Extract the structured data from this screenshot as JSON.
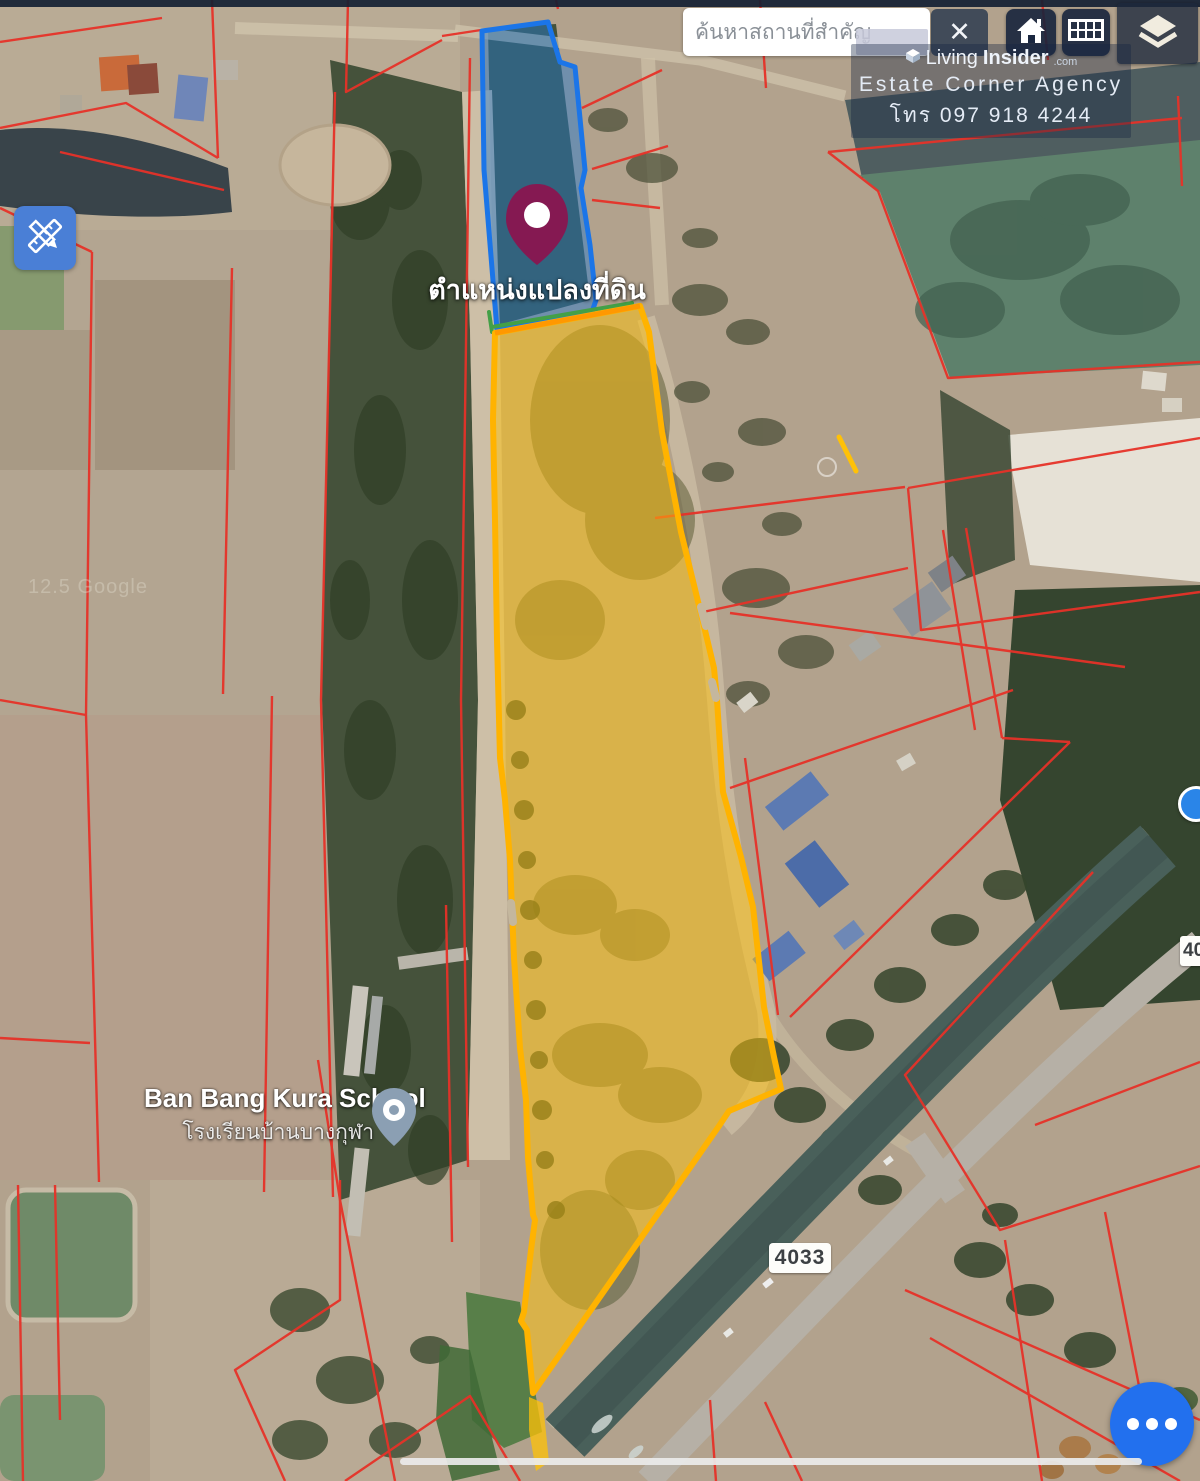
{
  "theme": {
    "plot_fill_yellow": "#FFC107",
    "plot_border_yellow": "#FFB300",
    "plot_top_border_orange": "#FF9800",
    "plot_border_green": "#43A047",
    "plot_fill_blue": "#1E78D2",
    "plot_border_blue": "#1B75E8",
    "parcel_line_red": "#E63228",
    "pin_color": "#8A1550",
    "fab_blue": "#2270EE",
    "edit_button_blue": "#4A7FD6",
    "control_bg_navy": "#16243C"
  },
  "search": {
    "placeholder": "ค้นหาสถานที่สำคัญ"
  },
  "toolbar": {
    "close_label": "✕"
  },
  "watermark": {
    "brand_word1": "Living",
    "brand_word2": "Insider",
    "brand_suffix": ".com",
    "agency": "Estate Corner Agency",
    "phone": "โทร 097 918 4244"
  },
  "map": {
    "plot_location_label": "ตำแหน่งแปลงที่ดิน",
    "school_name_en": "Ban Bang Kura School",
    "school_name_th": "โรงเรียนบ้านบางกุฬา",
    "road_shield": "4033",
    "road_shield_partial": "40",
    "faint_watermark": "12.5 Google"
  }
}
